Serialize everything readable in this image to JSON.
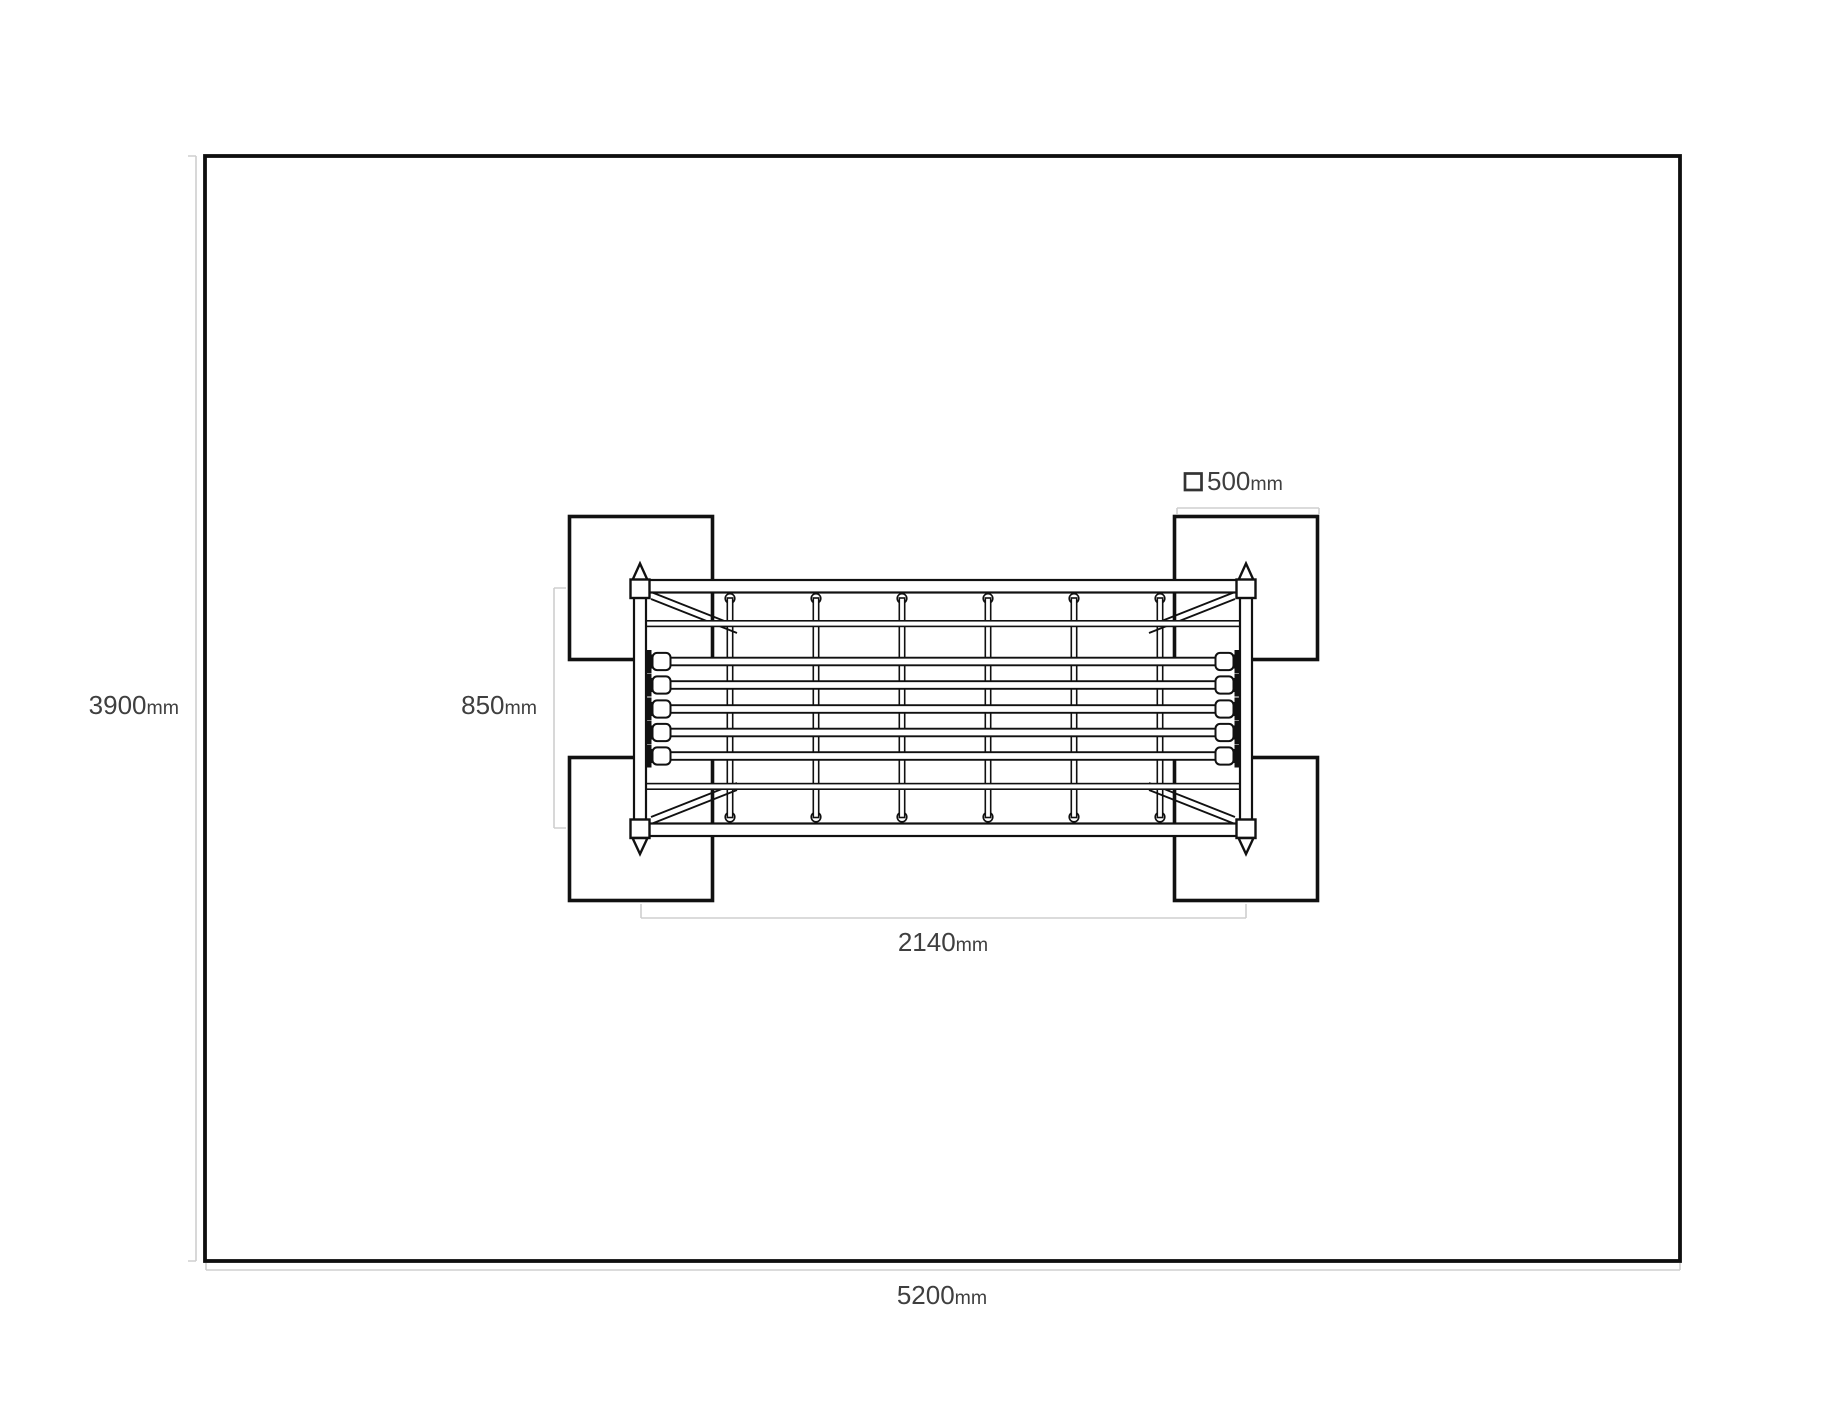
{
  "drawing": {
    "type": "top-view installation dimension drawing",
    "dimensions": {
      "area_width": {
        "value": "5200",
        "unit": "mm"
      },
      "area_depth": {
        "value": "3900",
        "unit": "mm"
      },
      "equipment_span": {
        "value": "2140",
        "unit": "mm"
      },
      "equipment_depth": {
        "value": "850",
        "unit": "mm"
      },
      "pad_size": {
        "value": "500",
        "unit": "mm"
      }
    },
    "colors": {
      "outline": "#111111",
      "dimension_line": "#cfcfcf",
      "label_text": "#3f3f3f",
      "background": "#ffffff"
    }
  }
}
